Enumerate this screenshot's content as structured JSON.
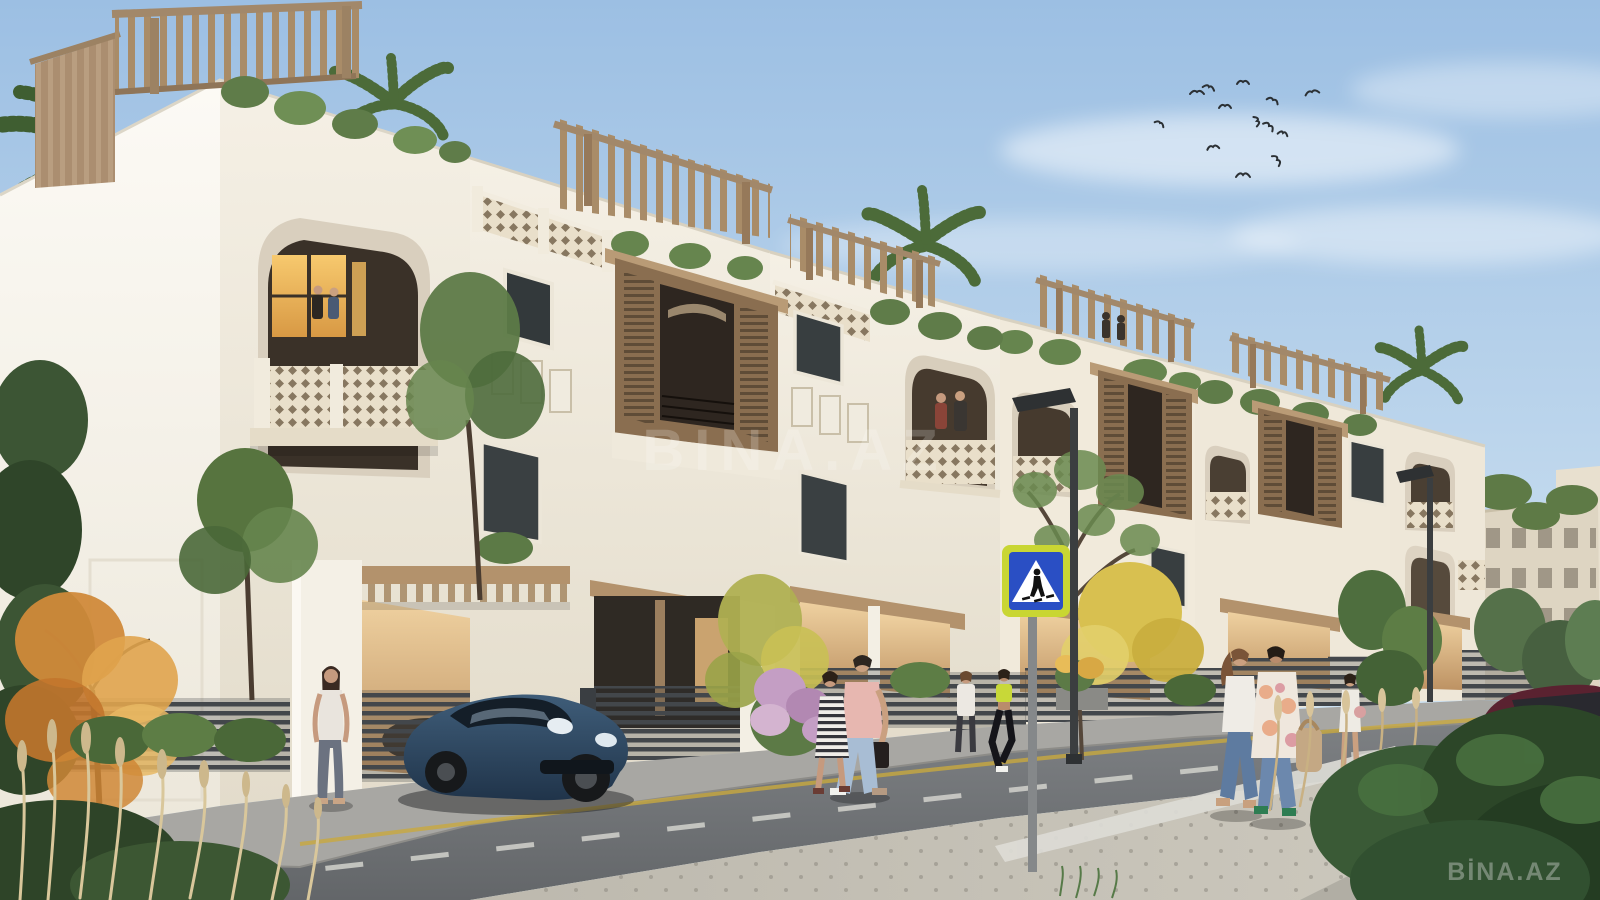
{
  "watermarks": {
    "center": "BINA.AZ",
    "corner": "BİNA.AZ"
  },
  "scene": {
    "description": "Sunny architectural rendering of a row of white three-storey Mediterranean-Arabic townhouses with rooftop wooden pergolas, roof gardens, mashrabiya wooden screens and arched lattice balconies along a new street; pedestrians walk and cross the road, a dark blue sports car is parked in a driveway, a dark red SUV stands at far right, birds fly in the sky and palms rise behind the roofs.",
    "sky": {
      "top_color": "#9cbfe3",
      "bottom_color": "#d4e6f3",
      "clouds": "soft wispy white",
      "birds_count": 13
    },
    "buildings": {
      "townhouse_count": 6,
      "style": "white stucco, arched balconies, cream lattice parapets, wooden mashrabiya screens, rooftop pergolas with plants",
      "wall_color": "#f3eee3",
      "wood_color": "#a98c68",
      "garage_interior_color": "#d8ab78",
      "distant_blocks": "beige mid-rise apartment buildings at far right"
    },
    "street": {
      "road_color": "#6e7174",
      "foreground_sidewalk_color": "#c6c2b8",
      "markings": [
        "white dashed lane line",
        "yellow edge line",
        "zebra crosswalk"
      ],
      "sign": {
        "name": "pedestrian-crossing-sign",
        "border_color": "#c9d633",
        "panel_color": "#2a4fc4",
        "triangle_color": "#ffffff",
        "figure_color": "#111111"
      },
      "street_lamp_count": 2
    },
    "vehicles": [
      {
        "name": "sports-car",
        "color": "#2c4258",
        "position": "parked in left driveway"
      },
      {
        "name": "suv",
        "color": "#5a2230",
        "position": "far right, partly out of frame"
      }
    ],
    "people": {
      "street_count": 8,
      "balcony_count": 4,
      "rooftop_count": 2,
      "notable": [
        "woman in white top by gate pillar",
        "couple walking with dark bag",
        "woman in striped dress",
        "jogger in lime top",
        "two women crossing with tan bag",
        "woman in white romper"
      ]
    },
    "vegetation": [
      "coconut palms",
      "rooftop shrubs",
      "orange autumn tree",
      "yellow autumn tree",
      "purple flowering bush",
      "dry ornamental grass plumes",
      "dense green hedges"
    ]
  }
}
